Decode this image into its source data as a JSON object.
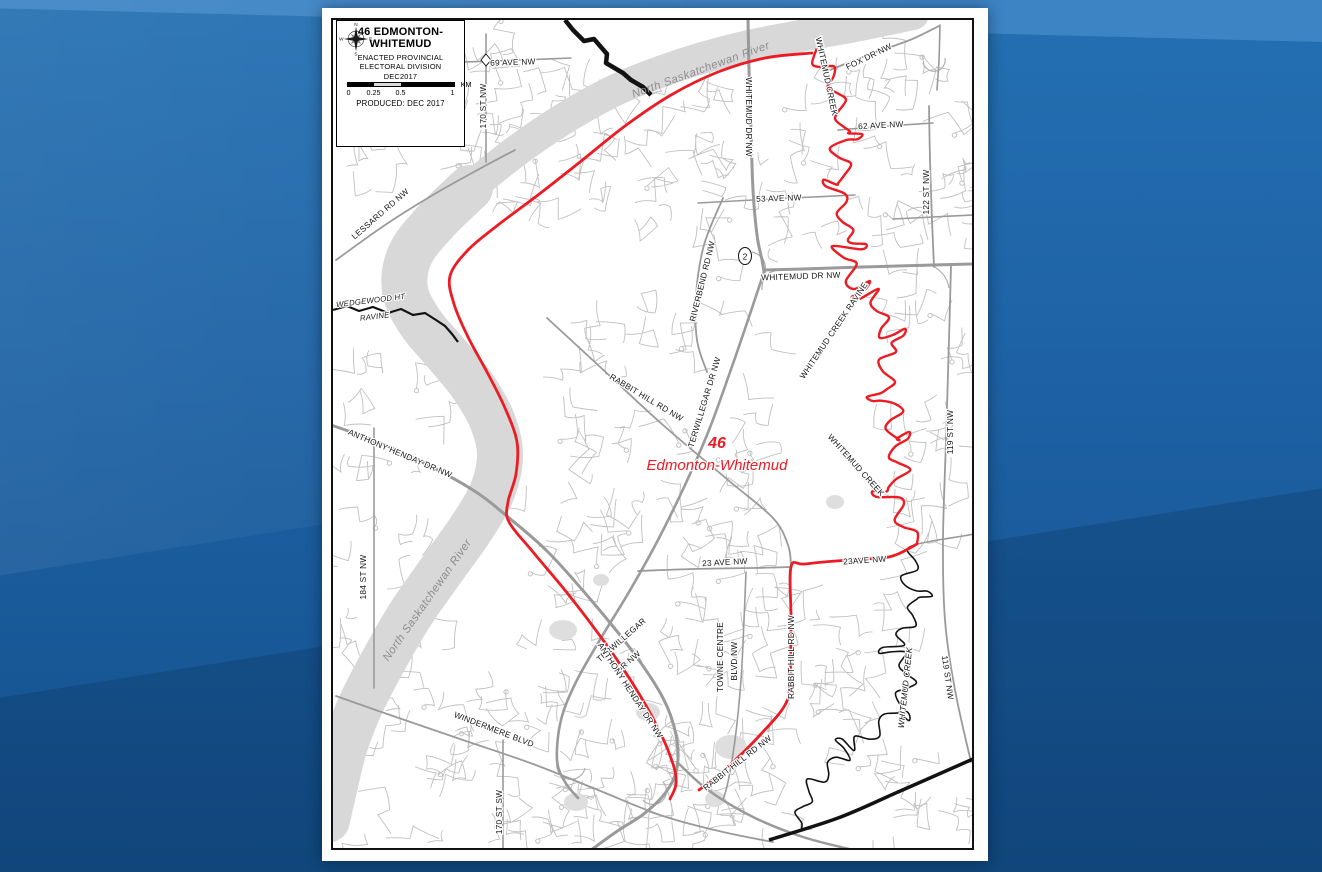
{
  "title_box": {
    "title_line1": "46 EDMONTON-",
    "title_line2": "WHITEMUD",
    "subtitle_lines": [
      "ENACTED PROVINCIAL",
      "ELECTORAL DIVISION",
      "DEC2017"
    ],
    "compass": {
      "n": "N",
      "e": "E",
      "s": "S",
      "w": "W"
    },
    "scale": {
      "ticks": [
        "0",
        "0.25",
        "0.5",
        "1"
      ],
      "unit": "KM"
    },
    "produced": "PRODUCED: DEC 2017"
  },
  "highway_shield": {
    "text": "2"
  },
  "colors": {
    "boundary_red": "#ed1c24",
    "river_gray": "#d8d8d8",
    "road_major": "#9a9a9a",
    "road_minor": "#bdbdbd",
    "black_line": "#121212",
    "label_black": "#161616",
    "label_river": "#8d8d8d",
    "bg_blue": "#1e63a6",
    "bg_blue_light": "#3d84c5"
  },
  "map_labels": [
    {
      "text": "69 AVE NW",
      "x": 180,
      "y": 45,
      "rot": -2,
      "kind": "road"
    },
    {
      "text": "170 ST NW",
      "x": 153,
      "y": 86,
      "rot": -90,
      "kind": "road"
    },
    {
      "text": "FOX DR NW",
      "x": 537,
      "y": 39,
      "rot": -26,
      "kind": "road"
    },
    {
      "text": "62 AVE NW",
      "x": 548,
      "y": 108,
      "rot": -3,
      "kind": "road"
    },
    {
      "text": "122 ST NW",
      "x": 596,
      "y": 172,
      "rot": -90,
      "kind": "road"
    },
    {
      "text": "WHITEMUD DR NW",
      "x": 413,
      "y": 97,
      "rot": 90,
      "kind": "road"
    },
    {
      "text": "53 AVE NW",
      "x": 446,
      "y": 181,
      "rot": -2,
      "kind": "road"
    },
    {
      "text": "WHITEMUD DR NW",
      "x": 468,
      "y": 259,
      "rot": -2,
      "kind": "road"
    },
    {
      "text": "LESSARD RD NW",
      "x": 49,
      "y": 196,
      "rot": -41,
      "kind": "road"
    },
    {
      "text": "WEDGEWOOD HT",
      "x": 38,
      "y": 283,
      "rot": -7,
      "kind": "ravine"
    },
    {
      "text": "RAVINE",
      "x": 42,
      "y": 299,
      "rot": -7,
      "kind": "ravine"
    },
    {
      "text": "RIVERBEND RD NW",
      "x": 372,
      "y": 262,
      "rot": -76,
      "kind": "road"
    },
    {
      "text": "RABBIT HILL RD NW",
      "x": 312,
      "y": 380,
      "rot": 31,
      "kind": "road"
    },
    {
      "text": "TERWILLEGAR DR NW",
      "x": 374,
      "y": 383,
      "rot": -73,
      "kind": "road"
    },
    {
      "text": "WHITEMUD CREEK RAVINE",
      "x": 503,
      "y": 312,
      "rot": -56,
      "kind": "road"
    },
    {
      "text": "WHITEMUD CREEK",
      "x": 491,
      "y": 57,
      "rot": 78,
      "kind": "road"
    },
    {
      "text": "119 ST NW",
      "x": 620,
      "y": 412,
      "rot": -90,
      "kind": "road"
    },
    {
      "text": "ANTHONY HENDAY DR NW",
      "x": 66,
      "y": 436,
      "rot": 23,
      "kind": "road"
    },
    {
      "text": "184 ST NW",
      "x": 33,
      "y": 557,
      "rot": -90,
      "kind": "road"
    },
    {
      "text": "23 AVE NW",
      "x": 392,
      "y": 545,
      "rot": -3,
      "kind": "road"
    },
    {
      "text": "23AVE NW",
      "x": 532,
      "y": 543,
      "rot": -4,
      "kind": "road"
    },
    {
      "text": "WHITEMUD CREEK",
      "x": 521,
      "y": 447,
      "rot": 48,
      "kind": "road"
    },
    {
      "text": "TERWILLEGAR",
      "x": 290,
      "y": 622,
      "rot": -41,
      "kind": "road"
    },
    {
      "text": "DR NW",
      "x": 297,
      "y": 644,
      "rot": -41,
      "kind": "road"
    },
    {
      "text": "ANTHONY HENDAY DR NW",
      "x": 295,
      "y": 672,
      "rot": 57,
      "kind": "road"
    },
    {
      "text": "TOWNE CENTRE",
      "x": 390,
      "y": 637,
      "rot": -90,
      "kind": "road"
    },
    {
      "text": "BLVD NW",
      "x": 404,
      "y": 641,
      "rot": -90,
      "kind": "road"
    },
    {
      "text": "RABBIT HILL RD NW",
      "x": 461,
      "y": 637,
      "rot": -90,
      "kind": "road"
    },
    {
      "text": "RABBIT HILL RD NW",
      "x": 406,
      "y": 745,
      "rot": -38,
      "kind": "road"
    },
    {
      "text": "WINDERMERE BLVD",
      "x": 160,
      "y": 712,
      "rot": 21,
      "kind": "road"
    },
    {
      "text": "170 ST SW",
      "x": 169,
      "y": 792,
      "rot": -90,
      "kind": "road"
    },
    {
      "text": "WHITEMUD CREEK",
      "x": 575,
      "y": 668,
      "rot": -84,
      "kind": "creek"
    },
    {
      "text": "119 ST NW",
      "x": 612,
      "y": 658,
      "rot": 82,
      "kind": "road"
    },
    {
      "text": "North Saskatchewan River",
      "x": 369,
      "y": 53,
      "rot": -20,
      "kind": "river"
    },
    {
      "text": "North Saskatchewan River",
      "x": 97,
      "y": 582,
      "rot": -55,
      "kind": "river"
    },
    {
      "text": "46",
      "x": 384,
      "y": 428,
      "rot": 0,
      "kind": "district-num"
    },
    {
      "text": "Edmonton-Whitemud",
      "x": 384,
      "y": 450,
      "rot": 0,
      "kind": "district-name"
    }
  ]
}
